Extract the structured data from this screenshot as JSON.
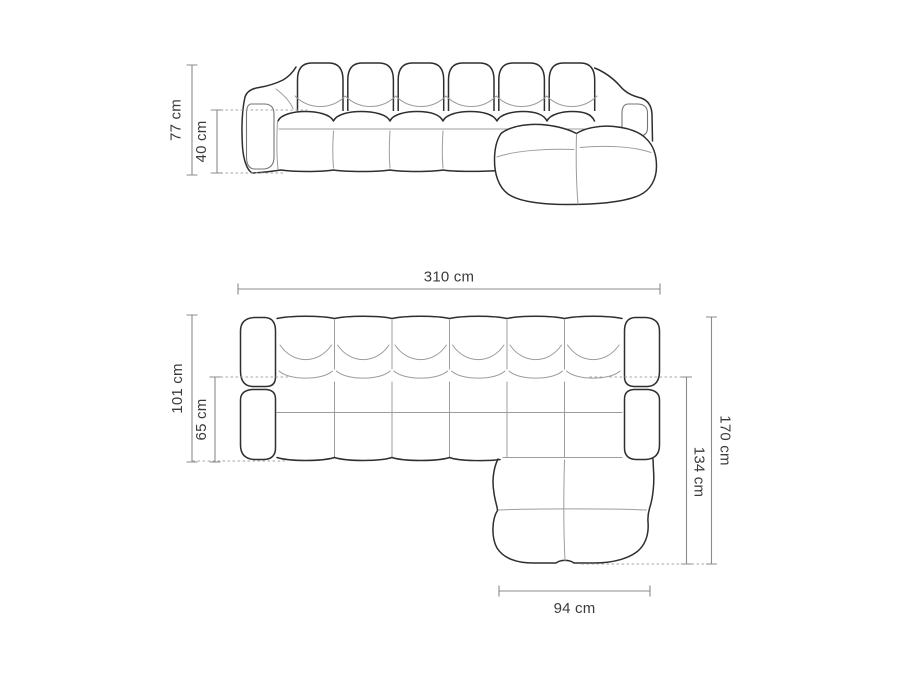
{
  "diagram": {
    "views": {
      "front": {
        "dimensions": {
          "total_height": "77 cm",
          "seat_height": "40 cm"
        }
      },
      "top": {
        "dimensions": {
          "total_width": "310 cm",
          "back_depth": "101 cm",
          "seat_depth": "65 cm",
          "total_depth": "170 cm",
          "chaise_depth": "134 cm",
          "chaise_width": "94 cm"
        }
      }
    },
    "colors": {
      "background": "#ffffff",
      "outline": "#2e2e2e",
      "seam": "#9c9c9c",
      "dimension_line": "#8b8b8b",
      "dotted_line": "#a3a3a3",
      "label_text": "#3b3b3b"
    }
  }
}
